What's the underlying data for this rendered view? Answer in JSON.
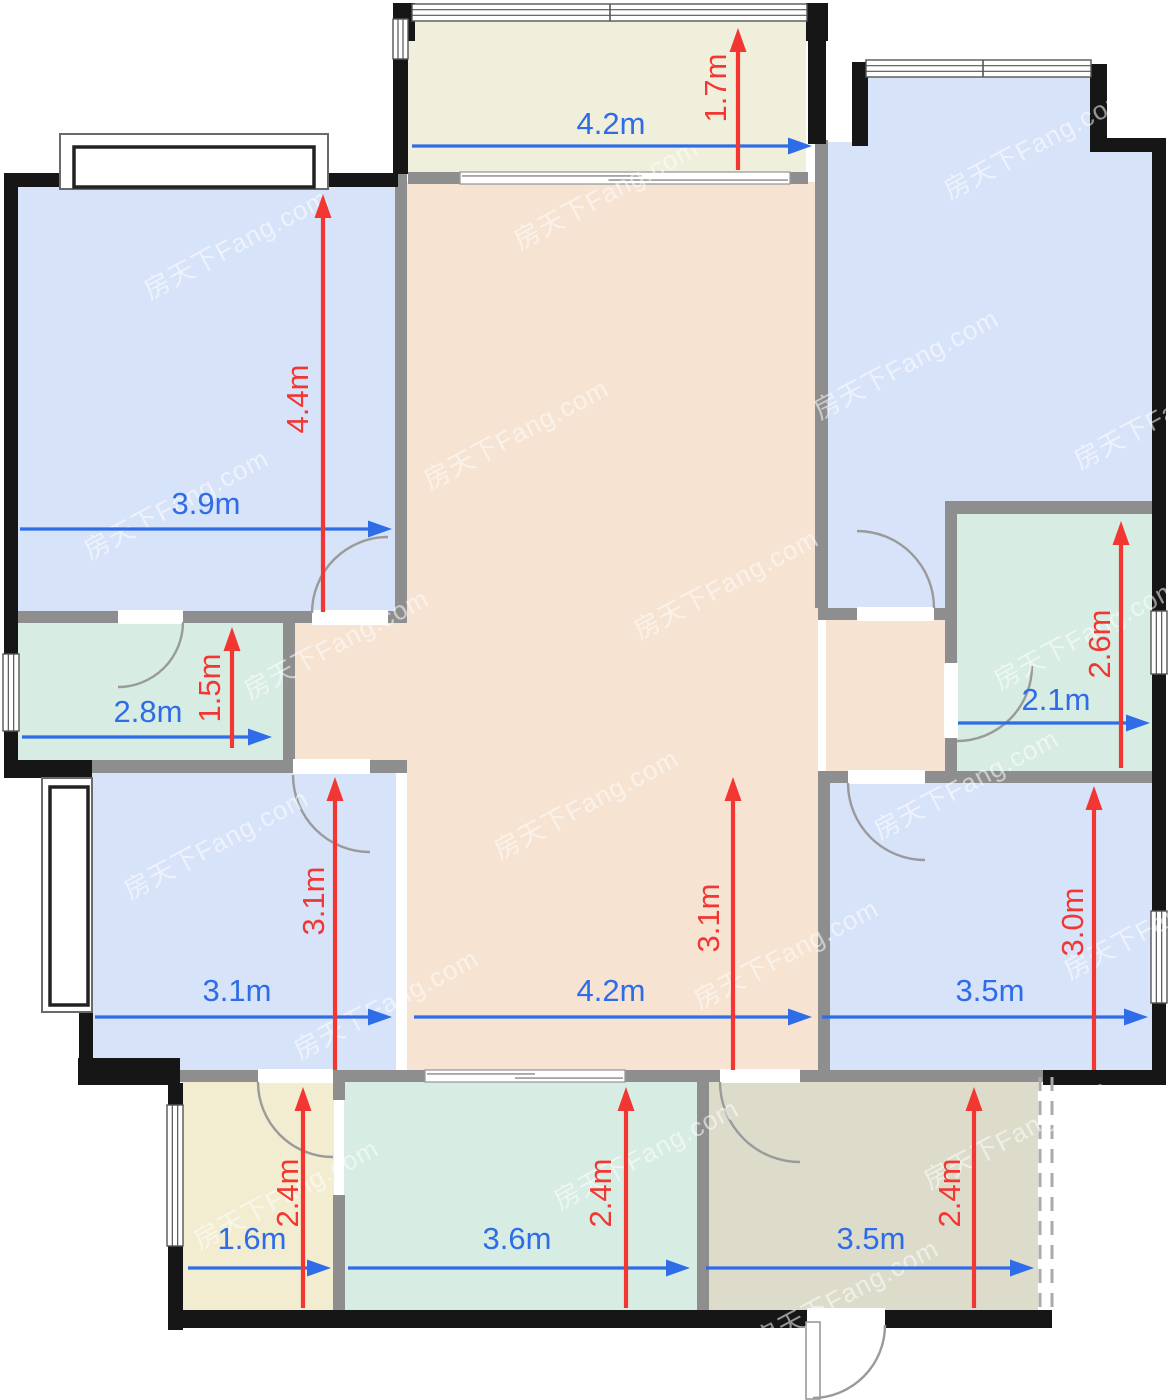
{
  "watermark": {
    "text": "房天下Fang.com"
  },
  "palette": {
    "wall_black": "#161616",
    "wall_gray": "#8e8e8e",
    "dim_blue": "#2e6ce8",
    "dim_red": "#f23733",
    "door_arc": "#9a9a9a",
    "dashed": "#aaaaaa",
    "room_blue": "#d7e3f9",
    "room_peach": "#f6e3d2",
    "room_mint": "#d7ece3",
    "room_cream": "#f0efdb",
    "room_yellow": "#f2edd0",
    "room_olive": "#dddccb"
  },
  "rooms_summary": [
    {
      "room": "master-bedroom-top-left",
      "width": "3.9m",
      "depth": "4.4m"
    },
    {
      "room": "balcony-top",
      "width": "4.2m",
      "depth": "1.7m"
    },
    {
      "room": "storage-left",
      "width": "2.8m",
      "depth": "1.5m"
    },
    {
      "room": "bathroom-right",
      "width": "2.1m",
      "depth": "2.6m"
    },
    {
      "room": "living-dining-hall",
      "width": "4.2m",
      "depth": "3.1m"
    },
    {
      "room": "bedroom-bottom-left",
      "width": "3.1m",
      "depth": "3.1m"
    },
    {
      "room": "bedroom-bottom-right",
      "width": "3.5m",
      "depth": "3.0m"
    },
    {
      "room": "bath-bottom-left",
      "width": "1.6m",
      "depth": "2.4m"
    },
    {
      "room": "kitchen-bottom",
      "width": "3.6m",
      "depth": "2.4m"
    },
    {
      "room": "foyer-bottom-right",
      "width": "3.5m",
      "depth": "2.4m"
    }
  ],
  "floorplan": {
    "width": 1173,
    "height": 1400,
    "rooms": [
      {
        "name": "room-master-bedroom",
        "rect": [
          18,
          184,
          377,
          429
        ],
        "color": "room_blue"
      },
      {
        "name": "room-balcony",
        "rect": [
          408,
          15,
          398,
          158
        ],
        "color": "room_cream"
      },
      {
        "name": "room-bedroom-top-right-a",
        "rect": [
          866,
          74,
          224,
          76
        ],
        "color": "room_blue"
      },
      {
        "name": "room-bedroom-top-right-b",
        "rect": [
          827,
          142,
          328,
          366
        ],
        "color": "room_blue"
      },
      {
        "name": "room-bedroom-top-right-c",
        "rect": [
          827,
          505,
          120,
          110
        ],
        "color": "room_blue"
      },
      {
        "name": "room-living-hall-main",
        "rect": [
          407,
          182,
          411,
          891
        ],
        "color": "room_peach"
      },
      {
        "name": "room-living-hall-right-arm",
        "rect": [
          826,
          617,
          120,
          156
        ],
        "color": "room_peach"
      },
      {
        "name": "room-living-hall-left-arm",
        "rect": [
          295,
          620,
          113,
          143
        ],
        "color": "room_peach"
      },
      {
        "name": "room-storage",
        "rect": [
          18,
          620,
          266,
          142
        ],
        "color": "room_mint"
      },
      {
        "name": "room-bedroom-bottom-left",
        "rect": [
          92,
          773,
          304,
          299
        ],
        "color": "room_blue"
      },
      {
        "name": "room-bathroom",
        "rect": [
          955,
          512,
          197,
          261
        ],
        "color": "room_mint"
      },
      {
        "name": "room-bedroom-bottom-right",
        "rect": [
          828,
          781,
          324,
          291
        ],
        "color": "room_blue"
      },
      {
        "name": "room-bath-2",
        "rect": [
          182,
          1080,
          152,
          232
        ],
        "color": "room_yellow"
      },
      {
        "name": "room-kitchen",
        "rect": [
          344,
          1080,
          354,
          232
        ],
        "color": "room_mint"
      },
      {
        "name": "room-foyer",
        "rect": [
          708,
          1080,
          330,
          232
        ],
        "color": "room_olive"
      }
    ],
    "walls_gray": [
      [
        395,
        173,
        12,
        450
      ],
      [
        18,
        611,
        100,
        12
      ],
      [
        183,
        611,
        129,
        12
      ],
      [
        388,
        611,
        19,
        12
      ],
      [
        283,
        611,
        12,
        161
      ],
      [
        92,
        760,
        201,
        13
      ],
      [
        370,
        760,
        37,
        13
      ],
      [
        408,
        172,
        52,
        12
      ],
      [
        790,
        172,
        18,
        12
      ],
      [
        815,
        140,
        13,
        468
      ],
      [
        818,
        608,
        39,
        12
      ],
      [
        934,
        608,
        23,
        12
      ],
      [
        945,
        501,
        221,
        13
      ],
      [
        945,
        501,
        12,
        162
      ],
      [
        945,
        738,
        12,
        45
      ],
      [
        818,
        771,
        30,
        12
      ],
      [
        925,
        771,
        227,
        12
      ],
      [
        818,
        771,
        12,
        311
      ],
      [
        92,
        1070,
        333,
        12
      ],
      [
        625,
        1070,
        95,
        12
      ],
      [
        800,
        1070,
        243,
        12
      ],
      [
        333,
        1082,
        12,
        18
      ],
      [
        333,
        1195,
        12,
        117
      ],
      [
        697,
        1082,
        12,
        230
      ]
    ],
    "walls_black": [
      [
        4,
        173,
        14,
        482
      ],
      [
        4,
        730,
        14,
        45
      ],
      [
        4,
        760,
        88,
        18
      ],
      [
        4,
        173,
        63,
        14
      ],
      [
        322,
        173,
        76,
        14
      ],
      [
        393,
        3,
        22,
        38
      ],
      [
        806,
        3,
        22,
        38
      ],
      [
        393,
        58,
        15,
        116
      ],
      [
        808,
        3,
        18,
        141
      ],
      [
        852,
        62,
        16,
        84
      ],
      [
        1090,
        64,
        17,
        86
      ],
      [
        1090,
        138,
        76,
        14
      ],
      [
        1152,
        138,
        14,
        473
      ],
      [
        1152,
        673,
        14,
        240
      ],
      [
        1152,
        1002,
        14,
        83
      ],
      [
        1043,
        1070,
        123,
        15
      ],
      [
        77,
        768,
        15,
        15
      ],
      [
        79,
        1008,
        14,
        70
      ],
      [
        78,
        1058,
        102,
        27
      ],
      [
        168,
        1083,
        15,
        23
      ],
      [
        168,
        1245,
        15,
        85
      ],
      [
        168,
        1310,
        639,
        18
      ],
      [
        885,
        1310,
        167,
        18
      ]
    ],
    "windows": [
      {
        "kind": "bay",
        "outer": [
          60,
          134,
          268,
          55
        ],
        "inner": [
          74,
          147,
          240,
          40
        ],
        "name": "window-master-bay"
      },
      {
        "kind": "bay",
        "outer": [
          42,
          778,
          50,
          234
        ],
        "inner": [
          50,
          787,
          38,
          218
        ],
        "name": "window-bedroom2-bay"
      },
      {
        "kind": "h",
        "rect": [
          412,
          4,
          395,
          17
        ],
        "ticks": [
          610
        ],
        "name": "window-balcony-top"
      },
      {
        "kind": "h",
        "rect": [
          866,
          60,
          225,
          17
        ],
        "ticks": [
          983
        ],
        "name": "window-bedroom-top-right"
      },
      {
        "kind": "v",
        "rect": [
          393,
          19,
          15,
          40
        ],
        "ticks": [],
        "name": "window-balcony-left"
      },
      {
        "kind": "v",
        "rect": [
          3,
          654,
          16,
          77
        ],
        "ticks": [],
        "name": "window-storage-left"
      },
      {
        "kind": "v",
        "rect": [
          1151,
          611,
          16,
          63
        ],
        "ticks": [],
        "name": "window-bathroom-right"
      },
      {
        "kind": "v",
        "rect": [
          1151,
          911,
          16,
          92
        ],
        "ticks": [],
        "name": "window-bedroom3-right"
      },
      {
        "kind": "v",
        "rect": [
          167,
          1105,
          16,
          141
        ],
        "ticks": [],
        "name": "window-bath2-left"
      }
    ],
    "sliders": [
      {
        "rect": [
          460,
          172,
          330,
          12
        ],
        "name": "sliding-door-balcony"
      },
      {
        "rect": [
          425,
          1070,
          200,
          12
        ],
        "name": "sliding-door-kitchen"
      }
    ],
    "doors": [
      {
        "gap": [
          312,
          610,
          76,
          15
        ],
        "arc": "M312,613 A76,76 0 0 1 388,537",
        "name": "door-master-bedroom"
      },
      {
        "gap": [
          118,
          610,
          65,
          14
        ],
        "arc": "M183,622 A65,65 0 0 1 118,687",
        "name": "door-storage"
      },
      {
        "gap": [
          293,
          759,
          77,
          15
        ],
        "arc": "M293,775 A77,77 0 0 0 370,852",
        "name": "door-bedroom-bottom-left"
      },
      {
        "gap": [
          857,
          607,
          77,
          14
        ],
        "arc": "M934,608 A77,77 0 0 0 857,531",
        "name": "door-bedroom-top-right"
      },
      {
        "gap": [
          944,
          663,
          14,
          75
        ],
        "arc": "M1032,666 A75,75 0 0 1 957,741",
        "name": "door-bathroom"
      },
      {
        "gap": [
          848,
          770,
          77,
          14
        ],
        "arc": "M848,783 A77,77 0 0 0 925,860",
        "name": "door-bedroom-bottom-right"
      },
      {
        "gap": [
          258,
          1069,
          75,
          14
        ],
        "arc": "M258,1082 A75,75 0 0 0 333,1157",
        "name": "door-bath-2"
      },
      {
        "gap": [
          720,
          1069,
          80,
          14
        ],
        "arc": "M720,1082 A80,80 0 0 0 800,1162",
        "name": "door-foyer"
      },
      {
        "gap": [
          807,
          1308,
          78,
          22
        ],
        "leaf": [
          806,
          1322,
          14,
          77
        ],
        "arc": "M885,1325 A73,73 0 0 1 813,1398",
        "name": "door-main-entrance"
      }
    ],
    "dashed": [
      {
        "x": 1040,
        "y1": 1077,
        "y2": 1312
      },
      {
        "x": 1052,
        "y1": 1077,
        "y2": 1312
      }
    ],
    "dims": [
      {
        "label": "3.9m",
        "color": "blue",
        "lx": 206,
        "ly": 506,
        "rot": false,
        "arrow": [
          20,
          529,
          392,
          529
        ]
      },
      {
        "label": "4.4m",
        "color": "red",
        "lx": 300,
        "ly": 399,
        "rot": true,
        "arrow": [
          323,
          612,
          323,
          194
        ]
      },
      {
        "label": "4.2m",
        "color": "blue",
        "lx": 611,
        "ly": 126,
        "rot": false,
        "arrow": [
          412,
          146,
          812,
          146
        ]
      },
      {
        "label": "1.7m",
        "color": "red",
        "lx": 718,
        "ly": 88,
        "rot": true,
        "arrow": [
          738,
          170,
          738,
          28
        ]
      },
      {
        "label": "2.8m",
        "color": "blue",
        "lx": 148,
        "ly": 714,
        "rot": false,
        "arrow": [
          22,
          737,
          272,
          737
        ]
      },
      {
        "label": "1.5m",
        "color": "red",
        "lx": 212,
        "ly": 688,
        "rot": true,
        "arrow": [
          232,
          748,
          232,
          627
        ]
      },
      {
        "label": "2.1m",
        "color": "blue",
        "lx": 1056,
        "ly": 702,
        "rot": false,
        "arrow": [
          958,
          723,
          1150,
          723
        ]
      },
      {
        "label": "2.6m",
        "color": "red",
        "lx": 1102,
        "ly": 644,
        "rot": true,
        "arrow": [
          1121,
          768,
          1121,
          521
        ]
      },
      {
        "label": "4.2m",
        "color": "blue",
        "lx": 611,
        "ly": 993,
        "rot": false,
        "arrow": [
          414,
          1017,
          812,
          1017
        ]
      },
      {
        "label": "3.1m",
        "color": "red",
        "lx": 711,
        "ly": 918,
        "rot": true,
        "arrow": [
          733,
          1070,
          733,
          777
        ]
      },
      {
        "label": "3.1m",
        "color": "blue",
        "lx": 237,
        "ly": 993,
        "rot": false,
        "arrow": [
          95,
          1017,
          392,
          1017
        ]
      },
      {
        "label": "3.1m",
        "color": "red",
        "lx": 316,
        "ly": 901,
        "rot": true,
        "arrow": [
          335,
          1070,
          335,
          777
        ]
      },
      {
        "label": "3.5m",
        "color": "blue",
        "lx": 990,
        "ly": 993,
        "rot": false,
        "arrow": [
          822,
          1017,
          1148,
          1017
        ]
      },
      {
        "label": "3.0m",
        "color": "red",
        "lx": 1075,
        "ly": 922,
        "rot": true,
        "arrow": [
          1094,
          1070,
          1094,
          786
        ]
      },
      {
        "label": "1.6m",
        "color": "blue",
        "lx": 252,
        "ly": 1241,
        "rot": false,
        "arrow": [
          188,
          1268,
          331,
          1268
        ]
      },
      {
        "label": "2.4m",
        "color": "red",
        "lx": 290,
        "ly": 1193,
        "rot": true,
        "arrow": [
          303,
          1308,
          303,
          1087
        ]
      },
      {
        "label": "3.6m",
        "color": "blue",
        "lx": 517,
        "ly": 1241,
        "rot": false,
        "arrow": [
          348,
          1268,
          690,
          1268
        ]
      },
      {
        "label": "2.4m",
        "color": "red",
        "lx": 603,
        "ly": 1193,
        "rot": true,
        "arrow": [
          626,
          1308,
          626,
          1087
        ]
      },
      {
        "label": "3.5m",
        "color": "blue",
        "lx": 871,
        "ly": 1241,
        "rot": false,
        "arrow": [
          706,
          1268,
          1034,
          1268
        ]
      },
      {
        "label": "2.4m",
        "color": "red",
        "lx": 952,
        "ly": 1193,
        "rot": true,
        "arrow": [
          974,
          1308,
          974,
          1087
        ]
      }
    ],
    "watermarks": [
      [
        150,
        300
      ],
      [
        520,
        250
      ],
      [
        950,
        200
      ],
      [
        90,
        560
      ],
      [
        430,
        490
      ],
      [
        820,
        420
      ],
      [
        1080,
        470
      ],
      [
        250,
        700
      ],
      [
        640,
        640
      ],
      [
        1000,
        690
      ],
      [
        130,
        900
      ],
      [
        500,
        860
      ],
      [
        880,
        840
      ],
      [
        300,
        1060
      ],
      [
        700,
        1010
      ],
      [
        1070,
        980
      ],
      [
        200,
        1250
      ],
      [
        560,
        1210
      ],
      [
        930,
        1190
      ],
      [
        760,
        1350
      ]
    ]
  }
}
